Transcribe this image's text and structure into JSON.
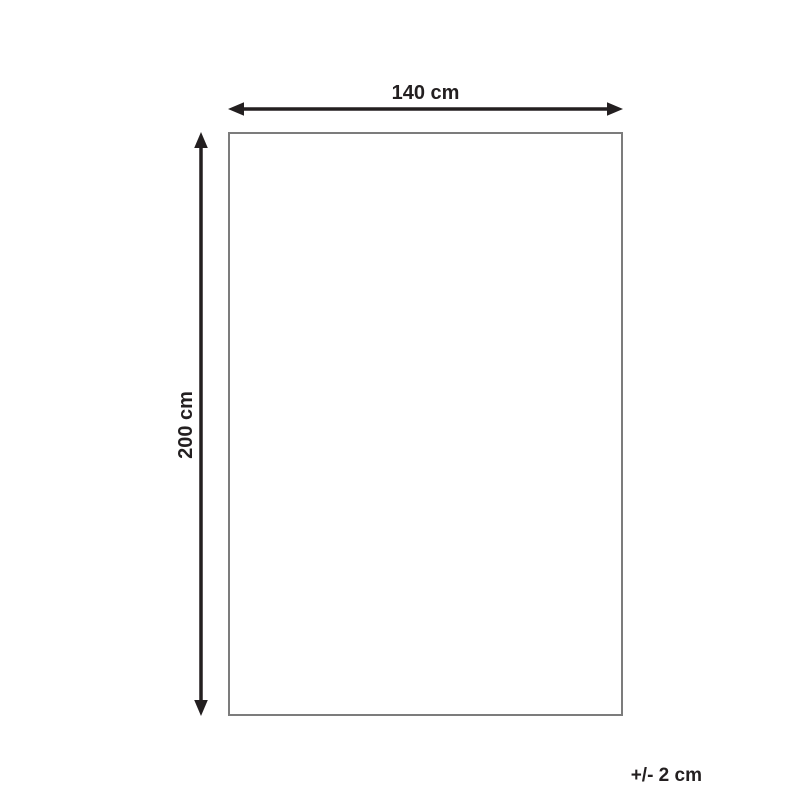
{
  "diagram": {
    "width_label": "140 cm",
    "height_label": "200 cm",
    "tolerance_label": "+/- 2 cm",
    "width_cm": 140,
    "height_cm": 200,
    "tolerance_cm": 2,
    "colors": {
      "line": "#231f20",
      "rectangle_border": "#7c7c7c",
      "background": "#ffffff"
    }
  }
}
